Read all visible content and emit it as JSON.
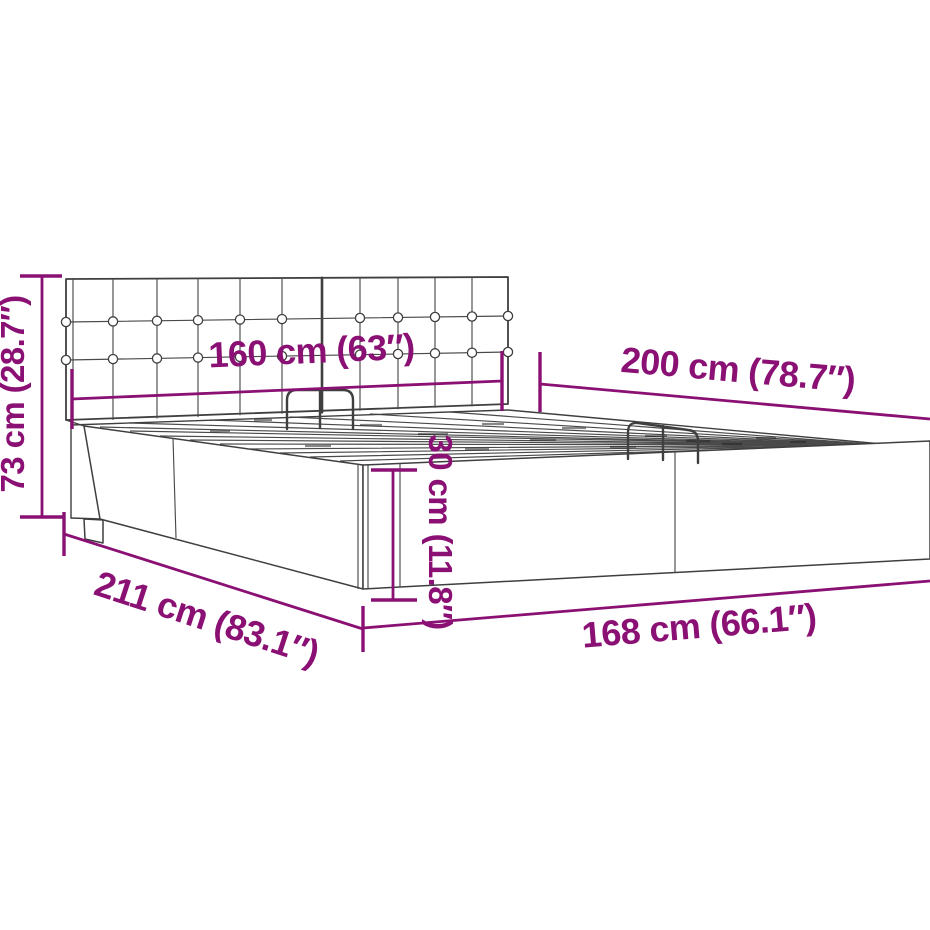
{
  "diagram": {
    "kind": "furniture-dimension-diagram",
    "background_color": "#ffffff",
    "drawing_line_color": "#3f3f3f",
    "accent_color": "#8a1074",
    "dims": [
      {
        "name": "headboard-height",
        "label": "73 cm (28.7″)",
        "value_cm": 73,
        "value_in": 28.7
      },
      {
        "name": "headboard-width",
        "label": "160 cm (63″)",
        "value_cm": 160,
        "value_in": 63
      },
      {
        "name": "bed-length",
        "label": "200 cm (78.7″)",
        "value_cm": 200,
        "value_in": 78.7
      },
      {
        "name": "base-height",
        "label": "30 cm (11.8″)",
        "value_cm": 30,
        "value_in": 11.8
      },
      {
        "name": "total-length",
        "label": "211 cm (83.1″)",
        "value_cm": 211,
        "value_in": 83.1
      },
      {
        "name": "total-width",
        "label": "168 cm (66.1″)",
        "value_cm": 168,
        "value_in": 66.1
      }
    ]
  }
}
